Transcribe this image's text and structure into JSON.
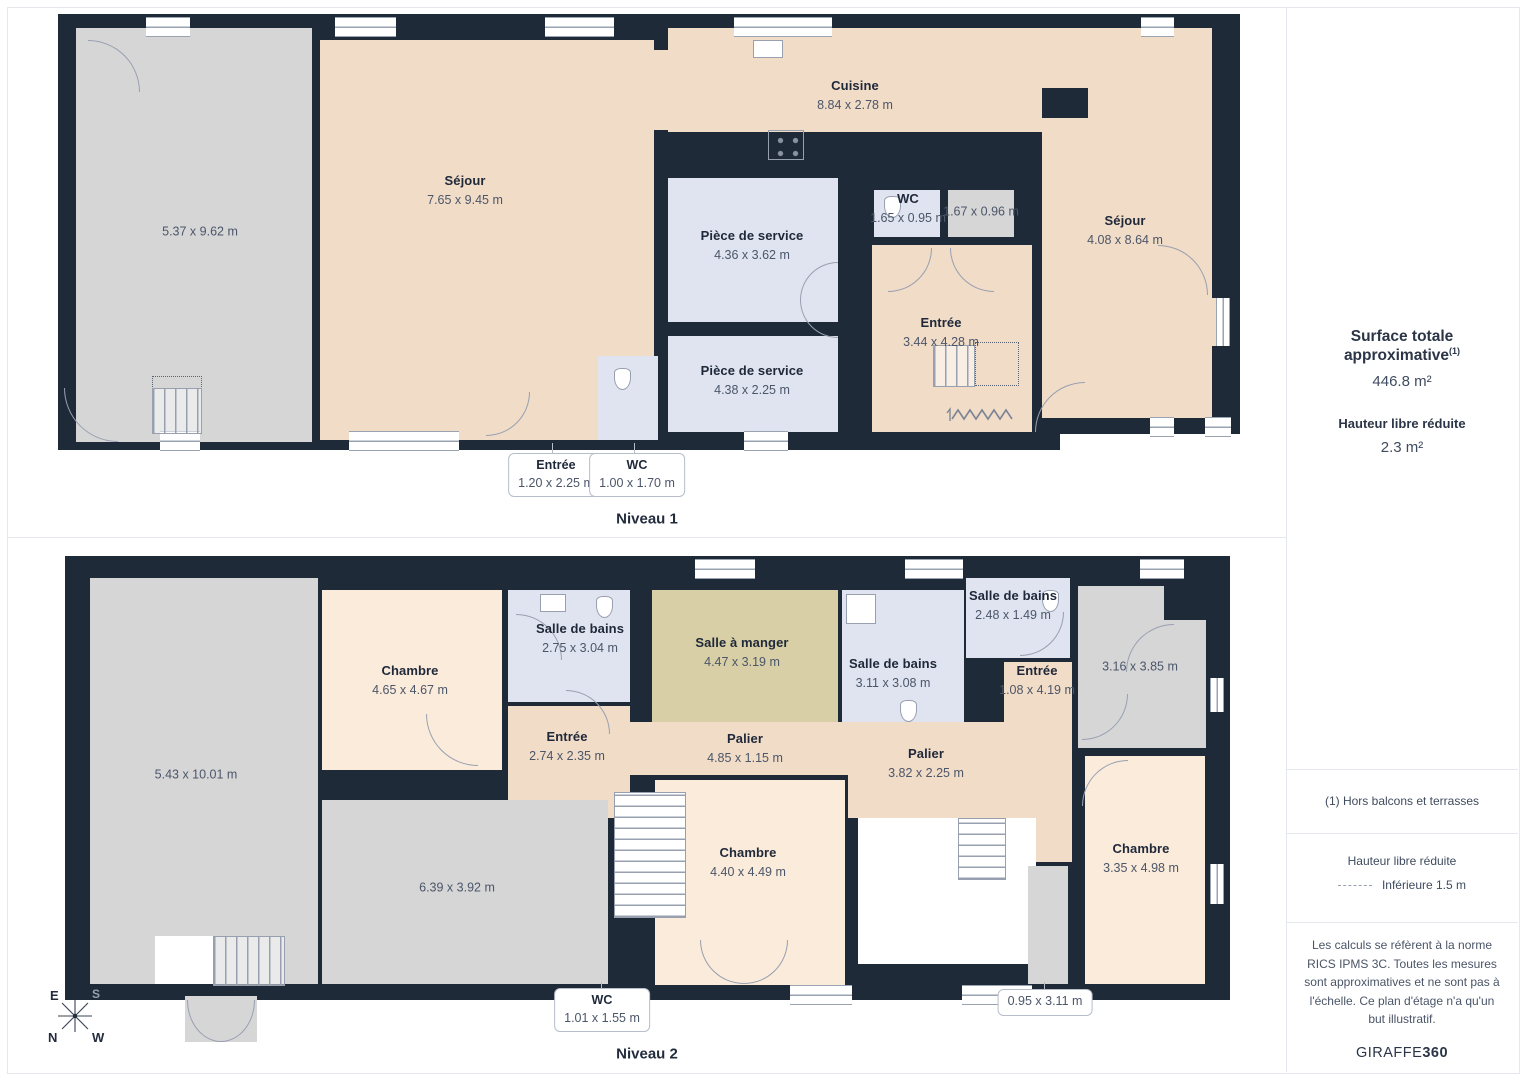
{
  "niveau1": {
    "label": "Niveau 1",
    "rooms": {
      "garage": {
        "dims": "5.37 x 9.62 m"
      },
      "sejour_grand": {
        "name": "Séjour",
        "dims": "7.65 x 9.45 m"
      },
      "cuisine": {
        "name": "Cuisine",
        "dims": "8.84 x 2.78 m"
      },
      "piece_service_1": {
        "name": "Pièce de service",
        "dims": "4.36 x 3.62 m"
      },
      "piece_service_2": {
        "name": "Pièce de service",
        "dims": "4.38 x 2.25 m"
      },
      "wc": {
        "name": "WC",
        "dims": "1.65 x 0.95 m"
      },
      "petite_piece": {
        "dims": "1.67 x 0.96 m"
      },
      "entree": {
        "name": "Entrée",
        "dims": "3.44 x 4.28 m"
      },
      "sejour_droit": {
        "name": "Séjour",
        "dims": "4.08 x 8.64 m"
      }
    },
    "callouts": {
      "entree": {
        "name": "Entrée",
        "dims": "1.20 x 2.25 m"
      },
      "wc": {
        "name": "WC",
        "dims": "1.00 x 1.70 m"
      }
    }
  },
  "niveau2": {
    "label": "Niveau 2",
    "rooms": {
      "grande_piece": {
        "dims": "5.43 x 10.01 m"
      },
      "chambre_1": {
        "name": "Chambre",
        "dims": "4.65 x 4.67 m"
      },
      "sdb_1": {
        "name": "Salle de bains",
        "dims": "2.75 x 3.04 m"
      },
      "salle_a_manger": {
        "name": "Salle à manger",
        "dims": "4.47 x 3.19 m"
      },
      "sdb_2": {
        "name": "Salle de bains",
        "dims": "3.11 x 3.08 m"
      },
      "sdb_3": {
        "name": "Salle de bains",
        "dims": "2.48 x 1.49 m"
      },
      "entree_droite": {
        "name": "Entrée",
        "dims": "1.08 x 4.19 m"
      },
      "piece_grise": {
        "dims": "3.16 x 3.85 m"
      },
      "entree_gauche": {
        "name": "Entrée",
        "dims": "2.74 x 2.35 m"
      },
      "palier_1": {
        "name": "Palier",
        "dims": "4.85 x 1.15 m"
      },
      "palier_2": {
        "name": "Palier",
        "dims": "3.82 x 2.25 m"
      },
      "chambre_2": {
        "name": "Chambre",
        "dims": "4.40 x 4.49 m"
      },
      "piece_grise_2": {
        "dims": "6.39 x 3.92 m"
      },
      "chambre_3": {
        "name": "Chambre",
        "dims": "3.35 x 4.98 m"
      }
    },
    "callouts": {
      "wc": {
        "name": "WC",
        "dims": "1.01 x 1.55 m"
      },
      "couloir": {
        "dims": "0.95 x 3.11 m"
      }
    }
  },
  "sidebar": {
    "surface_title": "Surface totale approximative",
    "surface_note_ref": "(1)",
    "surface_value": "446.8 m²",
    "height_title": "Hauteur libre réduite",
    "height_value": "2.3 m²",
    "footnote": "(1) Hors balcons et terrasses",
    "legend_title": "Hauteur libre réduite",
    "legend_item": "Inférieure 1.5 m",
    "disclaimer": "Les calculs se réfèrent à la norme RICS IPMS 3C. Toutes les mesures sont approximatives et ne sont pas à l'échelle. Ce plan d'étage n'a qu'un but illustratif.",
    "brand_regular": "GIRAFFE",
    "brand_bold": "360"
  },
  "compass": {
    "n": "N",
    "e": "E",
    "s": "S",
    "w": "W"
  },
  "colors": {
    "wall": "#1e2a38",
    "peach": "#f1dcc7",
    "cream": "#fbebdb",
    "blue": "#dfe4f0",
    "gray": "#d6d6d7",
    "khaki": "#d8cfa6",
    "accent_text": "#232c3d"
  }
}
